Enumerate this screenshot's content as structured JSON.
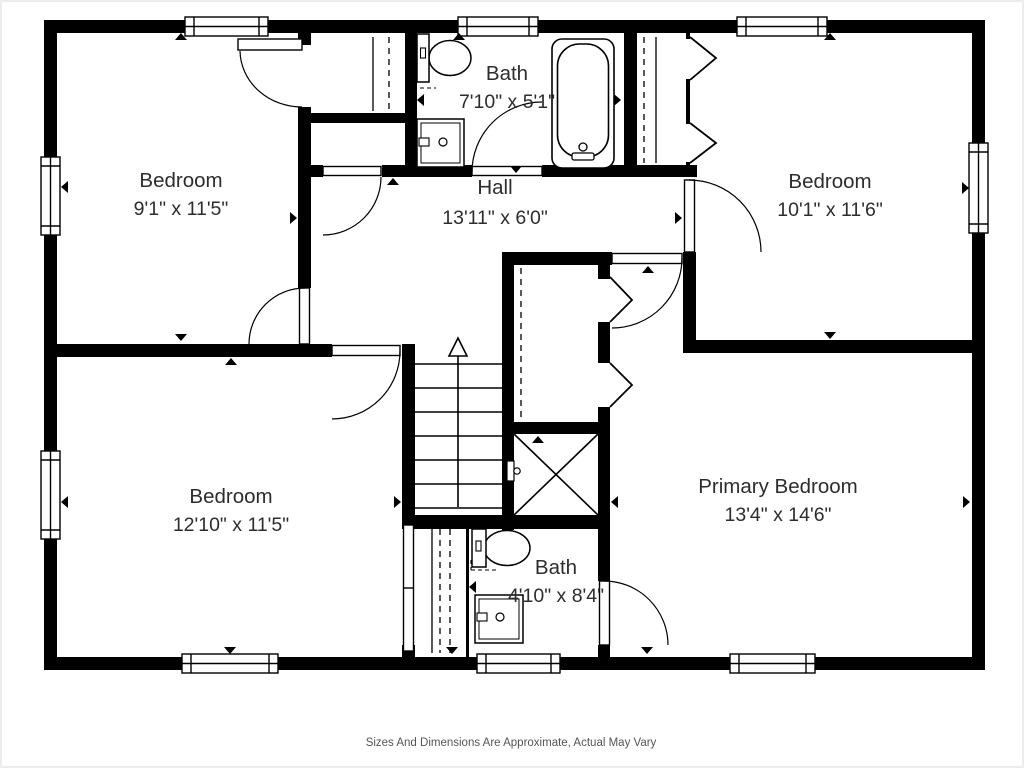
{
  "caption": "Sizes And Dimensions Are Approximate, Actual May Vary",
  "rooms": [
    {
      "id": "bedroom-top-left",
      "name": "Bedroom",
      "dimensions": "9'1\" x 11'5\""
    },
    {
      "id": "bath-top",
      "name": "Bath",
      "dimensions": "7'10\" x 5'1\""
    },
    {
      "id": "hall",
      "name": "Hall",
      "dimensions": "13'11\" x 6'0\""
    },
    {
      "id": "bedroom-top-right",
      "name": "Bedroom",
      "dimensions": "10'1\" x 11'6\""
    },
    {
      "id": "bedroom-bottom-left",
      "name": "Bedroom",
      "dimensions": "12'10\" x 11'5\""
    },
    {
      "id": "primary-bedroom",
      "name": "Primary Bedroom",
      "dimensions": "13'4\" x 14'6\""
    },
    {
      "id": "bath-bottom",
      "name": "Bath",
      "dimensions": "4'10\" x 8'4\""
    }
  ],
  "fixtures": [
    "bathtub",
    "toilet",
    "sink-vanity",
    "shower",
    "staircase",
    "closet-rod",
    "window",
    "door"
  ],
  "colors": {
    "wall": "#000000",
    "room_text": "#2d2d2d",
    "caption_text": "#555555",
    "background": "#ffffff"
  }
}
